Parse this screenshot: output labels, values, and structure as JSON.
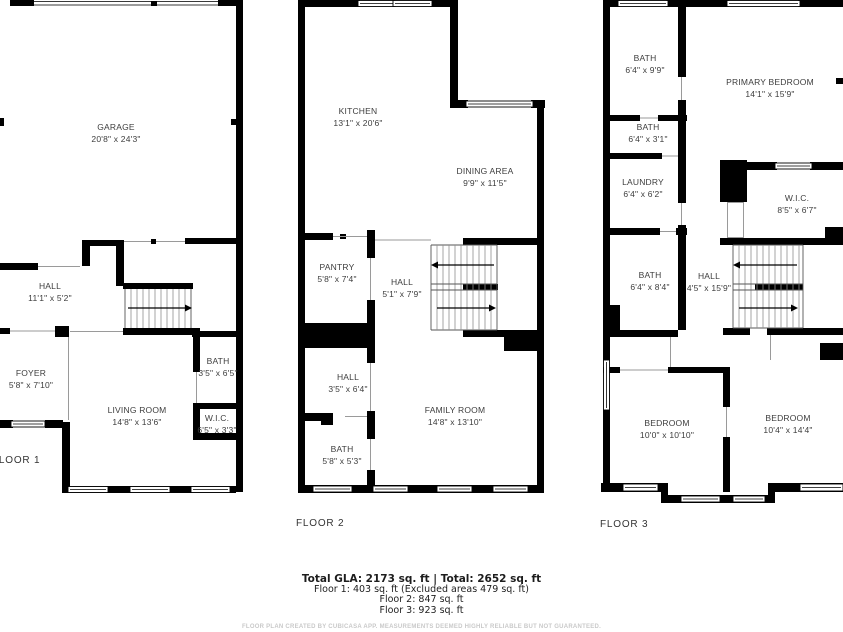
{
  "colors": {
    "wall": "#000000",
    "label_text": "#3d3d3d",
    "muted_text": "#c9c9c9"
  },
  "floors": [
    {
      "label": "FLOOR 1",
      "rooms": [
        {
          "name": "GARAGE",
          "dims": "20'8\" x 24'3\""
        },
        {
          "name": "HALL",
          "dims": "11'1\" x 5'2\""
        },
        {
          "name": "FOYER",
          "dims": "5'8\" x 7'10\""
        },
        {
          "name": "LIVING ROOM",
          "dims": "14'8\" x 13'6\""
        },
        {
          "name": "BATH",
          "dims": "3'5\" x 6'5\""
        },
        {
          "name": "W.I.C.",
          "dims": "6'5\" x 3'3\""
        }
      ]
    },
    {
      "label": "FLOOR 2",
      "rooms": [
        {
          "name": "KITCHEN",
          "dims": "13'1\" x 20'6\""
        },
        {
          "name": "DINING AREA",
          "dims": "9'9\" x 11'5\""
        },
        {
          "name": "PANTRY",
          "dims": "5'8\" x 7'4\""
        },
        {
          "name": "HALL",
          "dims": "5'1\" x 7'9\""
        },
        {
          "name": "HALL",
          "dims": "3'5\" x 6'4\""
        },
        {
          "name": "BATH",
          "dims": "5'8\" x 5'3\""
        },
        {
          "name": "FAMILY ROOM",
          "dims": "14'8\" x 13'10\""
        }
      ]
    },
    {
      "label": "FLOOR 3",
      "rooms": [
        {
          "name": "BATH",
          "dims": "6'4\" x 9'9\""
        },
        {
          "name": "PRIMARY BEDROOM",
          "dims": "14'1\" x 15'9\""
        },
        {
          "name": "BATH",
          "dims": "6'4\" x 3'1\""
        },
        {
          "name": "LAUNDRY",
          "dims": "6'4\" x 6'2\""
        },
        {
          "name": "W.I.C.",
          "dims": "8'5\" x 6'7\""
        },
        {
          "name": "BATH",
          "dims": "6'4\" x 8'4\""
        },
        {
          "name": "HALL",
          "dims": "4'5\" x 15'9\""
        },
        {
          "name": "BEDROOM",
          "dims": "10'0\" x 10'10\""
        },
        {
          "name": "BEDROOM",
          "dims": "10'4\" x 14'4\""
        }
      ]
    }
  ],
  "summary": {
    "total": "Total GLA: 2173 sq. ft | Total: 2652 sq. ft",
    "floor1": "Floor 1: 403 sq. ft (Excluded areas 479 sq. ft)",
    "floor2": "Floor 2: 847 sq. ft",
    "floor3": "Floor 3: 923 sq. ft"
  },
  "disclaimer": "FLOOR PLAN CREATED BY CUBICASA APP. MEASUREMENTS DEEMED HIGHLY RELIABLE BUT NOT GUARANTEED."
}
